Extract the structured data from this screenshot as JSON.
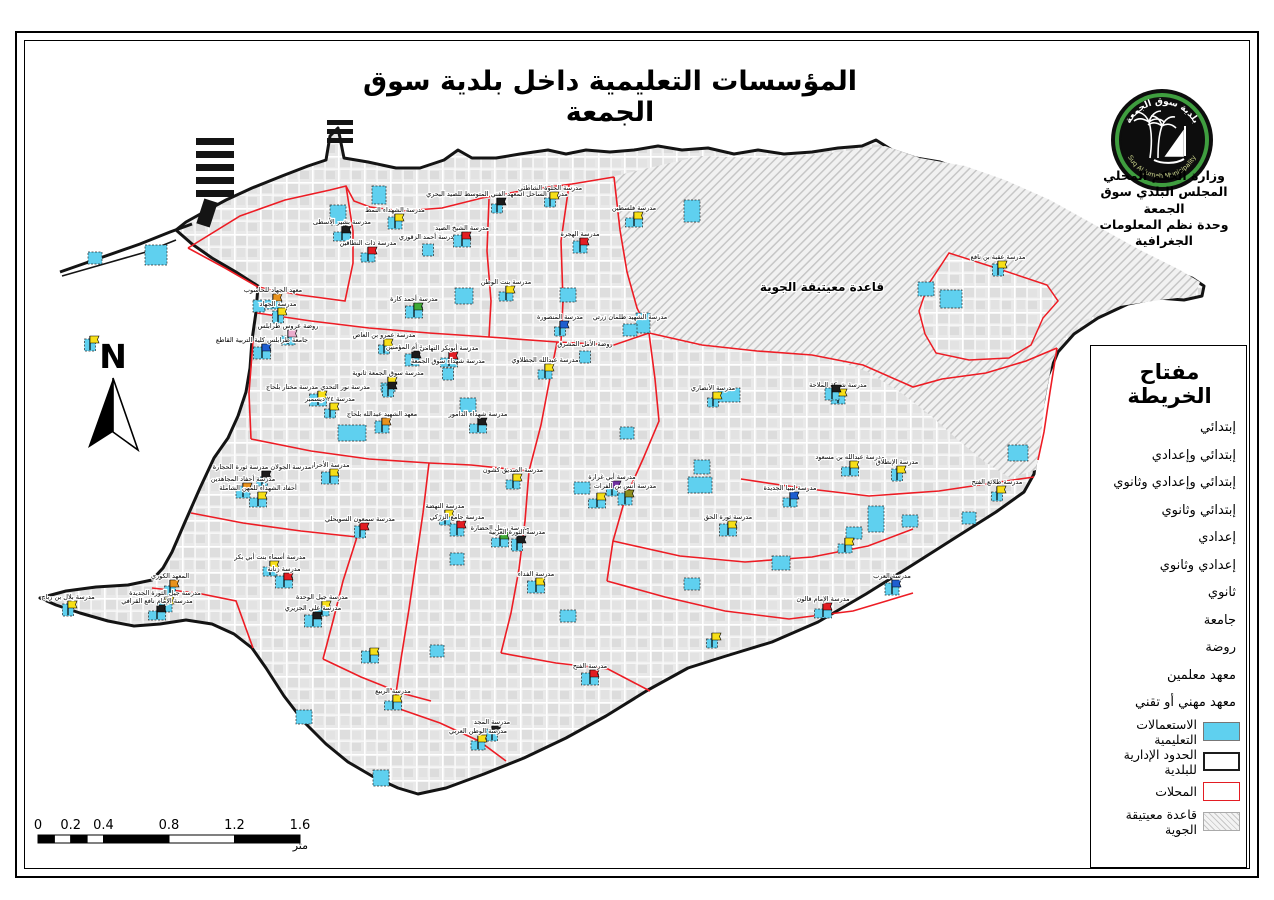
{
  "title": "المؤسسات التعليمية داخل بلدية سوق الجمعة",
  "org": {
    "lines": [
      "وزارة الحكم المحلي",
      "المجلس البلدي سوق الجمعة",
      "وحدة نظم المعلومات الجغرافية"
    ]
  },
  "logo": {
    "arabic": "بلدية سوق الجمعة",
    "english": "Suq Al Jumah Municipality"
  },
  "north_label": "N",
  "legend": {
    "title": "مفتاح الخريطة",
    "school_types": [
      "إبتدائي",
      "إبتدائي وإعدادي",
      "إبتدائي وإعدادي وثانوي",
      "إبتدائي وثانوي",
      "إعدادي",
      "إعدادي وثانوي",
      "ثانوي",
      "جامعة",
      "روضة",
      "معهد معلمين",
      "معهد مهني أو تقني"
    ],
    "area_items": [
      {
        "label": "الاستعمالات التعليمية",
        "swatch": "cyan"
      },
      {
        "label": "الحدود الإدارية للبلدية",
        "swatch": "black"
      },
      {
        "label": "المحلات",
        "swatch": "red"
      },
      {
        "label": "قاعدة معيتيقة الجوية",
        "swatch": "hatch"
      }
    ]
  },
  "scalebar": {
    "ticks": [
      "0",
      "0.2",
      "0.4",
      "0.8",
      "1.2",
      "1.6"
    ],
    "unit": "متر"
  },
  "map": {
    "airbase_label": "قاعدة معيتيقة الجوية",
    "colors": {
      "yellow": "#f7df17",
      "red": "#e31d23",
      "black": "#1c1c1c",
      "green": "#3faa35",
      "blue": "#1f5ed0",
      "orange": "#e8921c",
      "pink": "#eaaccd",
      "purple": "#6f2fa0",
      "olive": "#8f8f1e",
      "cyan": "#39c5ea",
      "municipal_boundary": "#141414",
      "locality_boundary": "#ed1c24",
      "school_fill": "#5fd0ef",
      "urban_block": "#e1e1e1"
    },
    "outline_path": "M40,598 L66,591 L96,587 L128,585 L152,580 L163,568 L172,552 L185,522 L200,488 L214,458 L228,438 L238,416 L246,392 L250,368 L252,340 L256,312 L258,286 L236,272 L212,258 L192,244 L176,230 L186,222 L204,212 L226,200 L252,188 L282,176 L308,166 L326,160 L330,136 L338,128 L344,158 L368,162 L396,168 L420,168 L444,160 L458,150 L472,158 L496,158 L520,154 L548,150 L566,154 L586,150 L610,152 L634,150 L658,146 L682,150 L708,148 L734,154 L758,150 L784,154 L812,152 L838,148 L862,146 L876,140 L892,150 L916,158 L940,162 L968,172 L996,180 L1024,194 L1052,210 L1082,228 L1112,246 L1142,260 L1170,270 L1192,278 L1204,286 L1202,296 L1184,300 L1158,298 L1128,304 L1098,318 L1074,334 L1058,352 L1048,376 L1042,410 L1038,446 L1034,474 L1024,492 L996,512 L958,536 L914,564 L866,594 L818,622 L772,642 L726,656 L688,668 L648,690 L606,716 L566,738 L524,758 L484,774 L446,788 L418,794 L398,788 L372,776 L348,762 L326,744 L304,722 L284,696 L266,668 L252,648 L234,634 L212,624 L186,620 L160,624 L134,626 L108,621 L80,613 L56,605 Z",
    "airbase_path": "M615,176 L700,156 L760,158 L830,153 L885,146 L920,158 L965,166 L1005,180 L1050,200 L1095,225 L1140,250 L1180,270 L1200,282 L1195,296 L1160,300 L1120,306 L1085,320 L1062,340 L1052,362 L1045,400 L1040,445 L1036,470 L1010,478 L985,462 L958,440 L930,415 L900,392 L868,372 L830,358 L788,352 L745,350 L700,346 L660,338 L640,315 L628,275 L620,225 Z",
    "enclave_path": "M949,253 L996,268 L1047,285 L1058,301 L1043,318 L1031,345 L1009,358 L969,360 L936,353 L925,334 L919,311 L928,285 Z",
    "locality_paths": [
      "M188,248 L240,216 L285,200 L330,190 L346,186 L354,201 L370,207 L402,211 L442,208 L482,198 L526,190 L572,184 L614,177",
      "M614,177 L620,230 L627,272 L637,308 L649,333",
      "M649,333 L702,345 L757,351 L812,355 L863,365 L913,387 L942,379 L986,373 L1026,361 L1057,348",
      "M1057,348 L1050,392 L1044,432 L1038,460",
      "M258,287 L300,295 L345,301 L353,263 L353,231 L346,186",
      "M257,313 L311,321 L369,328 L429,333 L489,337 L557,342 L614,345 L649,333",
      "M489,199 L487,251 L491,301 L489,337",
      "M569,185 L561,241 L563,301 L561,342",
      "M253,341 L249,393 L251,439",
      "M251,439 L311,451 L369,459 L429,463 L471,465 L529,471",
      "M529,471 L541,425 L549,383 L557,342",
      "M529,471 L525,521 L519,569 L511,613 L501,653",
      "M649,333 L655,379 L659,421 L643,459 L625,499 L613,541 L607,581",
      "M607,581 L665,597 L725,611 L789,619 L853,611 L913,593",
      "M741,479 L801,488 L869,496 L939,491 L1006,481 L1034,477",
      "M429,463 L423,513 L416,561 L409,609 L401,659 L394,707",
      "M191,513 L243,523 L301,531 L357,537",
      "M357,537 L343,581 L333,621 L323,659",
      "M323,659 L361,677 L401,693 L431,701",
      "M152,588 L197,593 L236,601 L253,648",
      "M501,653 L556,663 L608,669 L650,691",
      "M394,707 L440,723 L479,741 L506,761",
      "M188,248 L225,268 L258,287",
      "M613,541 L680,556 L745,562 L812,557 L868,546 L913,529"
    ],
    "schools": [
      {
        "label": "مدرسة الساحل المعهد الفني المتوسط للصيد البحري",
        "x": 497,
        "y": 210,
        "flag": "black"
      },
      {
        "label": "مدرسة الشهداء النمط",
        "x": 395,
        "y": 226,
        "flag": "yellow"
      },
      {
        "label": "مدرسة بشير الأسطى",
        "x": 342,
        "y": 238,
        "flag": "black"
      },
      {
        "label": "مدرسة أحمد الزقوزي",
        "x": 428,
        "y": 253,
        "flag": null
      },
      {
        "label": "مدرسة ذات النطاقين",
        "x": 368,
        "y": 259,
        "flag": "red"
      },
      {
        "label": "مدرسة الشيخ الصيد",
        "x": 462,
        "y": 244,
        "flag": "red"
      },
      {
        "label": "مدرسة الحلوة الشاطئي",
        "x": 550,
        "y": 204,
        "flag": "yellow"
      },
      {
        "label": "مدرسة الهجرة",
        "x": 580,
        "y": 250,
        "flag": "red"
      },
      {
        "label": "مدرسة فلسطين",
        "x": 634,
        "y": 224,
        "flag": "yellow"
      },
      {
        "label": "مدرسة عقبة بن نافع",
        "x": 998,
        "y": 273,
        "flag": "yellow"
      },
      {
        "label": "مدرسة بنت الوطن",
        "x": 506,
        "y": 298,
        "flag": "yellow"
      },
      {
        "label": "مدرسة أحمد كارة",
        "x": 414,
        "y": 315,
        "flag": "green"
      },
      {
        "label": "مدرسة المنصورة",
        "x": 560,
        "y": 333,
        "flag": "blue"
      },
      {
        "label": "مدرسة الشهيد طلمان زرتي",
        "x": 630,
        "y": 333,
        "flag": null
      },
      {
        "label": "معهد الجهاد للحاسوب",
        "x": 273,
        "y": 306,
        "flag": "orange"
      },
      {
        "label": "مدرسة الجهاد",
        "x": 278,
        "y": 320,
        "flag": "yellow"
      },
      {
        "label": "روضة عروس طرابلس",
        "x": 288,
        "y": 342,
        "flag": "pink"
      },
      {
        "label": "جامعة طرابلس كلية التربية القاطع",
        "x": 262,
        "y": 356,
        "flag": "blue"
      },
      {
        "label": "مدرسة عمرو بن العاص",
        "x": 384,
        "y": 351,
        "flag": "yellow"
      },
      {
        "label": "مدرسة أم المؤمنين",
        "x": 412,
        "y": 363,
        "flag": "black"
      },
      {
        "label": "مدرسة أبوبكر التهامي",
        "x": 449,
        "y": 364,
        "flag": "red"
      },
      {
        "label": "مدرسة شهداء سوق الجمعة",
        "x": 448,
        "y": 377,
        "flag": null
      },
      {
        "label": "مدرسة سوق الجمعة ثانوية",
        "x": 388,
        "y": 389,
        "flag": "yellow"
      },
      {
        "label": "مدرسة نور التحدي مدرسة مختار بلحاج",
        "x": 318,
        "y": 403,
        "flag": "yellow"
      },
      {
        "label": "مدرسة ٢٤ ديسمبر",
        "x": 330,
        "y": 415,
        "flag": "yellow"
      },
      {
        "label": "معهد الشهيد عبدالله بلحاج",
        "x": 382,
        "y": 430,
        "flag": "orange"
      },
      {
        "label": "مدرسة شهداء الدامور",
        "x": 478,
        "y": 430,
        "flag": "black"
      },
      {
        "label": "روضة الأمل المشرق",
        "x": 585,
        "y": 360,
        "flag": null
      },
      {
        "label": "مدرسة عبدالله الجطلاوي",
        "x": 545,
        "y": 376,
        "flag": "yellow"
      },
      {
        "label": "مدرسة الأحرار",
        "x": 330,
        "y": 481,
        "flag": "yellow"
      },
      {
        "label": "مدرسة الجولان مدرسة ثورة الحجارة",
        "x": 262,
        "y": 483,
        "flag": "black"
      },
      {
        "label": "مدرسة أحفاد المجاهدين",
        "x": 243,
        "y": 495,
        "flag": "orange"
      },
      {
        "label": "أحفاد الشهداء للمهن الشاملة",
        "x": 258,
        "y": 504,
        "flag": "yellow"
      },
      {
        "label": "مدرسة سمعون السويحلي",
        "x": 360,
        "y": 535,
        "flag": "red"
      },
      {
        "label": "مدرسة أسماء بنت أبي بكر",
        "x": 270,
        "y": 573,
        "flag": "yellow"
      },
      {
        "label": "مدرسة زنانة",
        "x": 284,
        "y": 585,
        "flag": "red"
      },
      {
        "label": "المعهد الكوري",
        "x": 170,
        "y": 592,
        "flag": "orange"
      },
      {
        "label": "مدرسة جيل الثورة الجديدة",
        "x": 165,
        "y": 609,
        "flag": "yellow"
      },
      {
        "label": "مدرسة الإمام نافع القرافي",
        "x": 157,
        "y": 617,
        "flag": "black"
      },
      {
        "label": "مدرسة بلال بن رباح",
        "x": 68,
        "y": 613,
        "flag": "yellow"
      },
      {
        "label": "مدرسة جيل الوحدة",
        "x": 322,
        "y": 613,
        "flag": "yellow"
      },
      {
        "label": "مدرسة علي الجزيري",
        "x": 313,
        "y": 624,
        "flag": "black"
      },
      {
        "label": "مدرسة النهضة",
        "x": 445,
        "y": 522,
        "flag": "yellow"
      },
      {
        "label": "مدرسة جامع الزركي",
        "x": 457,
        "y": 533,
        "flag": "red"
      },
      {
        "label": "مدرسة رسل الحضارة",
        "x": 500,
        "y": 544,
        "flag": "green"
      },
      {
        "label": "مدرسة الثورة العربية",
        "x": 517,
        "y": 548,
        "flag": "black"
      },
      {
        "label": "مدرسة الصديق كشون",
        "x": 513,
        "y": 486,
        "flag": "yellow"
      },
      {
        "label": "مدرسة الفداء",
        "x": 536,
        "y": 590,
        "flag": "yellow"
      },
      {
        "label": "مدرسة أبي غرارة",
        "x": 612,
        "y": 493,
        "flag": "purple"
      },
      {
        "label": "مدرسة أنس بن الفرات",
        "x": 625,
        "y": 502,
        "flag": "olive"
      },
      {
        "label": "مدرسة الربيع",
        "x": 393,
        "y": 707,
        "flag": "yellow"
      },
      {
        "label": "مدرسة المجد",
        "x": 492,
        "y": 738,
        "flag": "black"
      },
      {
        "label": "مدرسة الوطن العربي",
        "x": 478,
        "y": 747,
        "flag": "yellow"
      },
      {
        "label": "مدرسة الفتح",
        "x": 590,
        "y": 682,
        "flag": "red"
      },
      {
        "label": "مدرسة الأنصاري",
        "x": 713,
        "y": 404,
        "flag": "yellow"
      },
      {
        "label": "مدرسة شركة الملاحة",
        "x": 838,
        "y": 401,
        "flag": "yellow"
      },
      {
        "label": "مدرسة عبدالله بن مسعود",
        "x": 850,
        "y": 473,
        "flag": "yellow"
      },
      {
        "label": "مدرسة الإنطلاق",
        "x": 897,
        "y": 478,
        "flag": "yellow"
      },
      {
        "label": "مدرسة ليبيا الجديدة",
        "x": 790,
        "y": 504,
        "flag": "blue"
      },
      {
        "label": "مدرسة ثورة الحق",
        "x": 728,
        "y": 533,
        "flag": "yellow"
      },
      {
        "label": "مدرسة طلائع الفتح",
        "x": 997,
        "y": 498,
        "flag": "yellow"
      },
      {
        "label": "مدرسة العرب",
        "x": 892,
        "y": 592,
        "flag": "blue"
      },
      {
        "label": "مدرسة الإمام قالون",
        "x": 823,
        "y": 615,
        "flag": "red"
      },
      {
        "label": "",
        "x": 90,
        "y": 348,
        "flag": "yellow"
      },
      {
        "label": "",
        "x": 845,
        "y": 550,
        "flag": "yellow"
      },
      {
        "label": "",
        "x": 370,
        "y": 660,
        "flag": "yellow"
      },
      {
        "label": "",
        "x": 712,
        "y": 645,
        "flag": "yellow"
      },
      {
        "label": "",
        "x": 832,
        "y": 397,
        "flag": "black"
      },
      {
        "label": "",
        "x": 597,
        "y": 505,
        "flag": "yellow"
      },
      {
        "label": "",
        "x": 388,
        "y": 394,
        "flag": "black"
      }
    ],
    "plots": [
      [
        330,
        205,
        16,
        20
      ],
      [
        145,
        245,
        22,
        20
      ],
      [
        88,
        252,
        14,
        12
      ],
      [
        372,
        186,
        14,
        18
      ],
      [
        455,
        288,
        18,
        16
      ],
      [
        684,
        200,
        16,
        22
      ],
      [
        940,
        290,
        22,
        18
      ],
      [
        918,
        282,
        16,
        14
      ],
      [
        253,
        300,
        12,
        12
      ],
      [
        460,
        398,
        16,
        14
      ],
      [
        560,
        288,
        16,
        14
      ],
      [
        636,
        313,
        14,
        20
      ],
      [
        694,
        460,
        16,
        14
      ],
      [
        574,
        482,
        16,
        12
      ],
      [
        450,
        553,
        14,
        12
      ],
      [
        560,
        610,
        16,
        12
      ],
      [
        684,
        578,
        16,
        12
      ],
      [
        772,
        556,
        18,
        14
      ],
      [
        846,
        527,
        16,
        12
      ],
      [
        902,
        515,
        16,
        12
      ],
      [
        962,
        512,
        14,
        12
      ],
      [
        373,
        770,
        16,
        16
      ],
      [
        338,
        425,
        28,
        16
      ],
      [
        688,
        477,
        24,
        16
      ],
      [
        868,
        506,
        16,
        26
      ],
      [
        718,
        388,
        22,
        14
      ],
      [
        1008,
        445,
        20,
        16
      ],
      [
        296,
        710,
        16,
        14
      ],
      [
        430,
        645,
        14,
        12
      ],
      [
        620,
        427,
        14,
        12
      ]
    ]
  }
}
